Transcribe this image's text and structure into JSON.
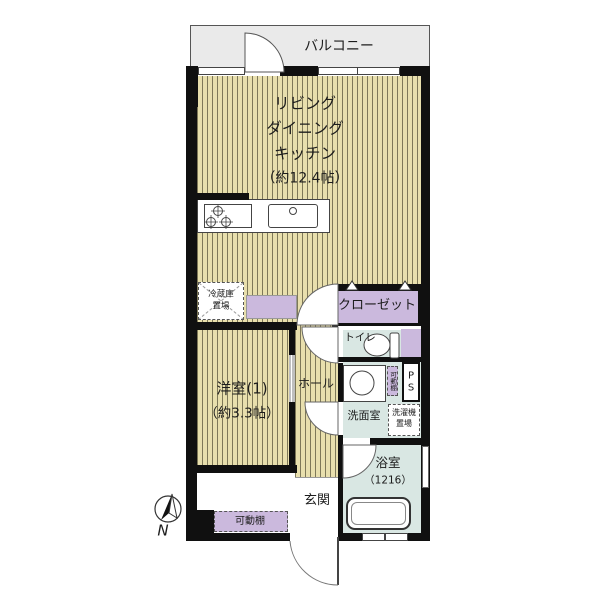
{
  "plan": {
    "balcony": "バルコニー",
    "ldk": {
      "line1": "リビング",
      "line2": "ダイニング",
      "line3": "キッチン",
      "line4": "（約12.4帖）"
    },
    "closet": "クローゼット",
    "fridge": {
      "line1": "冷蔵庫",
      "line2": "置場"
    },
    "toilet": "トイレ",
    "hall": "ホール",
    "western_room": {
      "line1": "洋室(1)",
      "line2": "（約3.3帖）"
    },
    "washroom": "洗面室",
    "laundry": {
      "line1": "洗濯機",
      "line2": "置場"
    },
    "bathroom": {
      "name": "浴室",
      "size": "（1216）"
    },
    "entrance": "玄関",
    "shelf_entrance": "可動棚",
    "shelf_washroom": "可動棚",
    "pipe_space": {
      "line1": "P",
      "line2": "S"
    },
    "north": "N"
  },
  "colors": {
    "floor_stripe_bg": "#E8DFAD",
    "floor_stripe_line": "#5A563C",
    "wall": "#101010",
    "closet_lavender": "#CBB9DD",
    "wet_area_cyan": "#D9E7E3",
    "balcony_gray": "#EAEAEA",
    "fixture_white": "#FFFFFF"
  },
  "icons": {
    "compass": "north-compass",
    "door_arcs": "hinged-door-swing",
    "slide_door": "sliding-door",
    "stove": "gas-stove-3-burner",
    "sink": "kitchen-sink",
    "toilet_fixture": "toilet-bowl",
    "bathtub": "bathtub"
  }
}
